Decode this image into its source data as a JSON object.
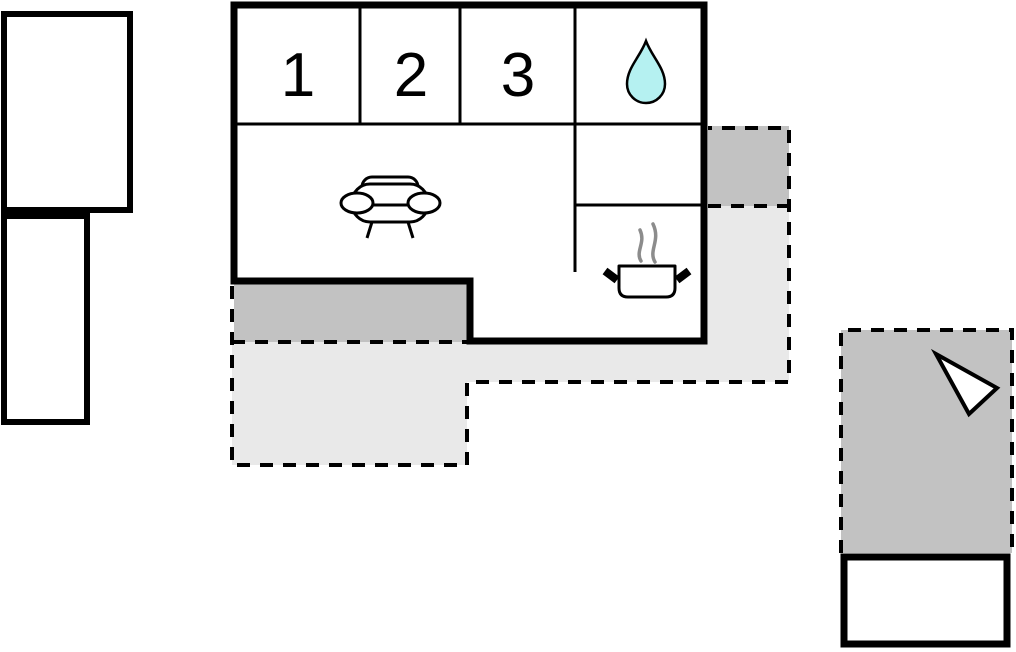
{
  "floor_plan": {
    "room_labels": [
      "1",
      "2",
      "3"
    ],
    "icons": {
      "bath": "water-drop-icon",
      "living": "sofa-icon",
      "kitchen": "cooking-pot-icon",
      "kitchen_steam": "steam-icon",
      "orientation": "arrow-icon"
    },
    "colors": {
      "wall": "#000000",
      "covered_terrace": "#c2c2c2",
      "open_terrace": "#e9e9e9",
      "water_drop": "#b5f1f1",
      "steam": "#8c8c8c",
      "background": "#ffffff"
    }
  }
}
